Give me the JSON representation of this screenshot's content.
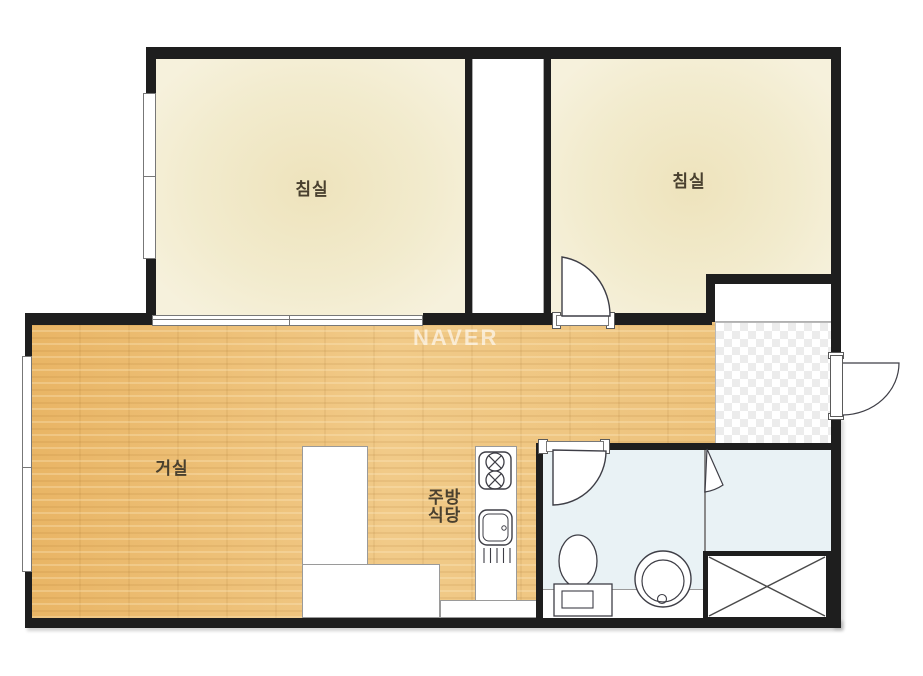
{
  "watermark": "NAVER",
  "rooms": {
    "bedroom_left": {
      "label": "침실"
    },
    "bedroom_right": {
      "label": "침실"
    },
    "living_room": {
      "label": "거실"
    },
    "kitchen_dining": {
      "label": "주방\n식당"
    }
  },
  "fixtures": {
    "stove": "two-burner-stove",
    "sink": "kitchen-sink",
    "toilet": "toilet",
    "washer": "washing-machine",
    "duct": "x-crossed-duct-shaft",
    "entrance": "checkered-tile-entry",
    "front_door": "entrance-door",
    "bedroom_door": "swing-door",
    "bathroom_door": "swing-door"
  },
  "colors": {
    "wall": "#1e1e1e",
    "wood_floor": "#ecbe74",
    "bedroom_floor": "#f2ebcd",
    "bathroom_floor": "#e9f2f5",
    "tile_gray": "#ececec",
    "fixture_line": "#3e3e46",
    "label_text": "#49402f",
    "watermark_white": "#ffffff"
  }
}
